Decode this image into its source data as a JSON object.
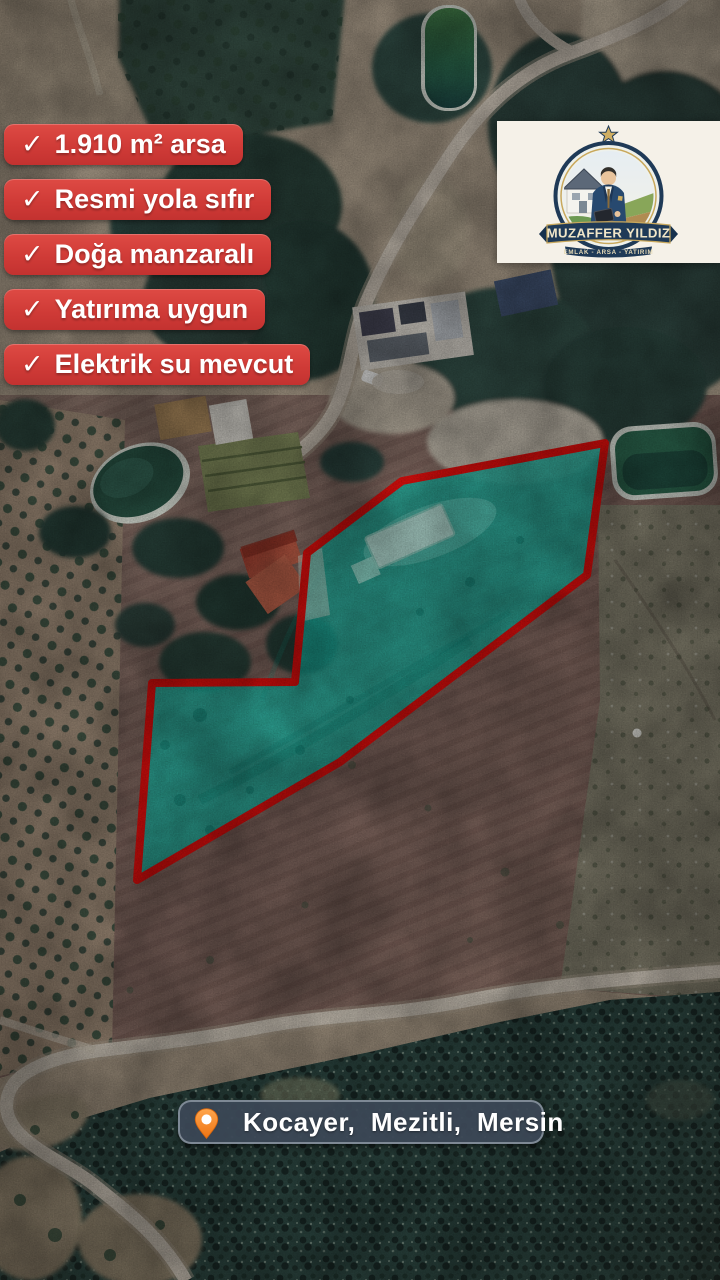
{
  "badges": {
    "check": "✓",
    "items": [
      {
        "label": "1.910 m² arsa"
      },
      {
        "label": "Resmi yola sıfır"
      },
      {
        "label": "Doğa manzaralı"
      },
      {
        "label": "Yatırıma uygun"
      },
      {
        "label": "Elektrik su mevcut"
      }
    ],
    "bg_color": "#d23d38",
    "text_color": "#ffffff"
  },
  "logo": {
    "name": "MUZAFFER YILDIZ",
    "tagline": "EMLAK - ARSA - YATIRIM",
    "card_color": "#f5f1e8",
    "navy": "#1f3a57",
    "gold": "#c9a85c"
  },
  "location": {
    "label": "Kocayer,  Mezitli,  Mersin",
    "pin_color": "#f58220",
    "bg_color": "#3c4756"
  },
  "parcel": {
    "outline_color": "#f2100e",
    "fill_color": "#1dbfad",
    "points": "605,443 402,481 307,553 295,682 152,683 137,880 340,762 587,575"
  }
}
